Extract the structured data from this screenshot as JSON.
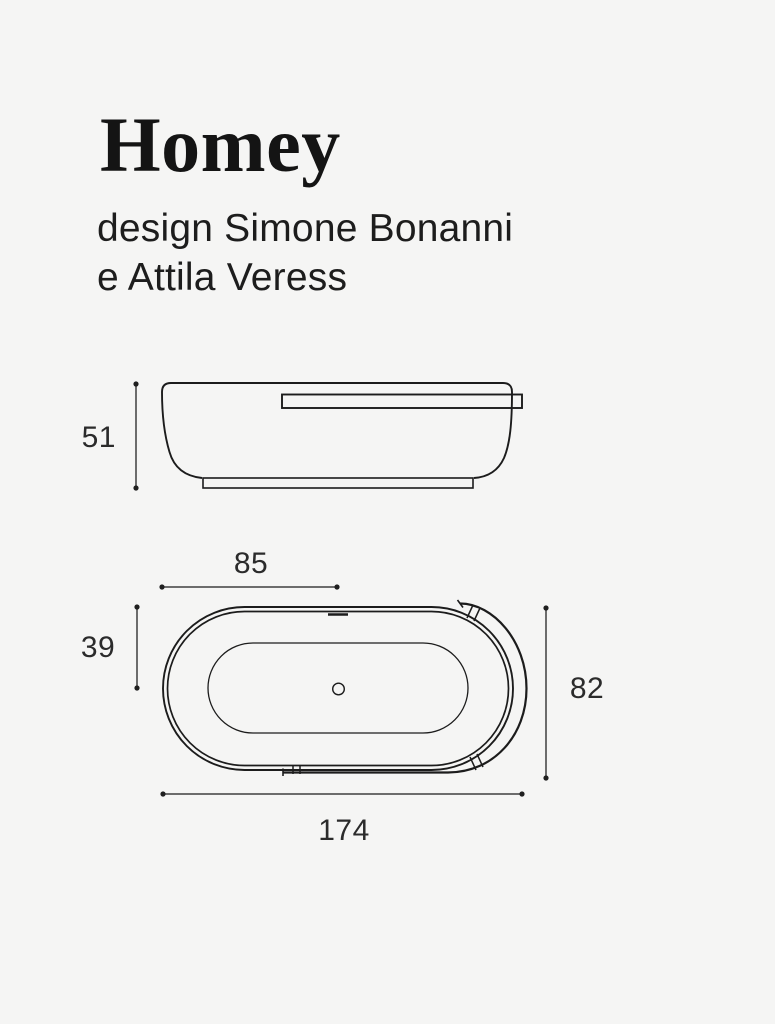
{
  "colors": {
    "background": "#f5f5f4",
    "ink": "#1c1c1c",
    "dimension_text": "#2b2b2b"
  },
  "header": {
    "title": "Homey",
    "subtitle_line1": "design Simone Bonanni",
    "subtitle_line2": "e Attila Veress"
  },
  "side_view": {
    "dims": {
      "height": "51"
    }
  },
  "top_view": {
    "dims": {
      "shelf_length": "85",
      "rim_to_center": "39",
      "width": "82",
      "overall_length": "174"
    }
  }
}
